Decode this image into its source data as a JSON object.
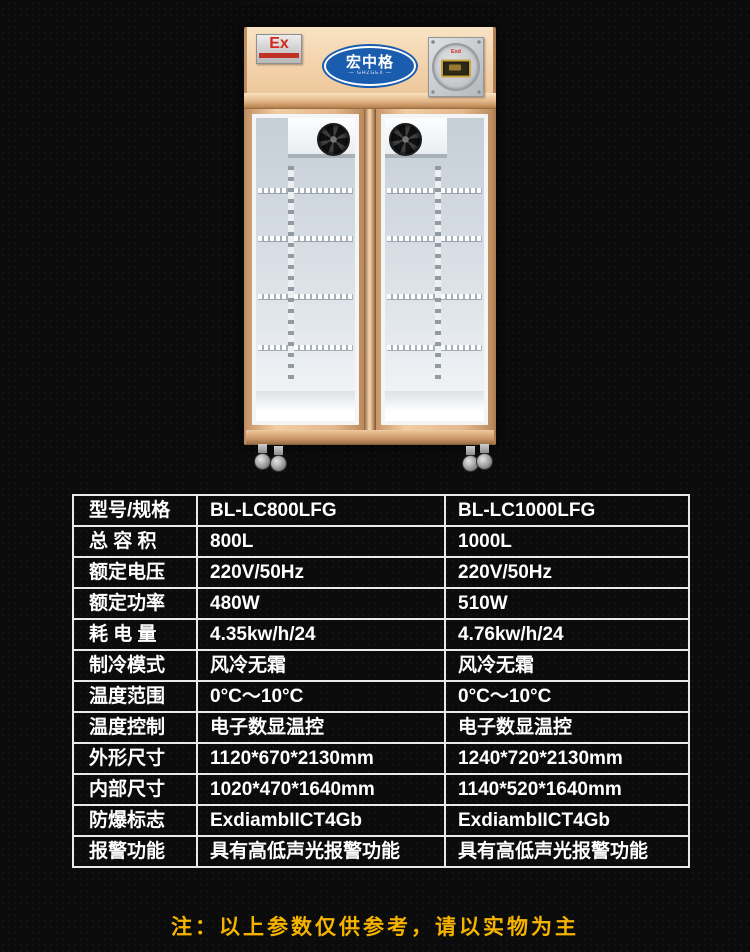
{
  "product": {
    "ex_label": "Ex",
    "brand_cn": "宏中格",
    "brand_en": "— GHZGEX —",
    "controller_label": "Exd"
  },
  "spec_table": {
    "rows": [
      {
        "label": "型号/规格",
        "col1": "BL-LC800LFG",
        "col2": "BL-LC1000LFG"
      },
      {
        "label": "总 容 积",
        "col1": "800L",
        "col2": "1000L"
      },
      {
        "label": "额定电压",
        "col1": "220V/50Hz",
        "col2": "220V/50Hz"
      },
      {
        "label": "额定功率",
        "col1": "480W",
        "col2": "510W"
      },
      {
        "label": "耗 电 量",
        "col1": "4.35kw/h/24",
        "col2": "4.76kw/h/24"
      },
      {
        "label": "制冷模式",
        "col1": "风冷无霜",
        "col2": "风冷无霜"
      },
      {
        "label": "温度范围",
        "col1": "0°C～10°C",
        "col2": "0°C～10°C"
      },
      {
        "label": "温度控制",
        "col1": "电子数显温控",
        "col2": "电子数显温控"
      },
      {
        "label": "外形尺寸",
        "col1": "1120*670*2130mm",
        "col2": "1240*720*2130mm"
      },
      {
        "label": "内部尺寸",
        "col1": "1020*470*1640mm",
        "col2": "1140*520*1640mm"
      },
      {
        "label": "防爆标志",
        "col1": "ExdiambIICT4Gb",
        "col2": "ExdiambIICT4Gb"
      },
      {
        "label": "报警功能",
        "col1": "具有高低声光报警功能",
        "col2": "具有高低声光报警功能"
      }
    ]
  },
  "note": {
    "text": "注：以上参数仅供参考，请以实物为主"
  },
  "colors": {
    "background": "#0B0B0B",
    "table_border": "#E9E9E9",
    "table_text": "#FFFFFF",
    "note_yellow": "#F6B400",
    "body_gold": "#E9C096",
    "logo_blue": "#1A5CAD",
    "ex_red": "#D4281E"
  }
}
